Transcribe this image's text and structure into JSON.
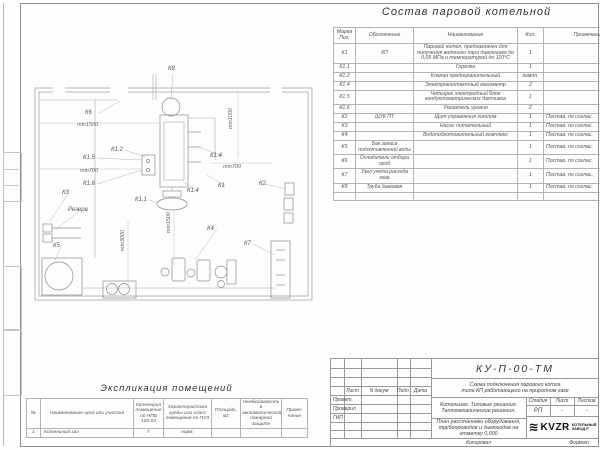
{
  "composition": {
    "title": "Состав паровой котельной",
    "headers": {
      "mark": "Марка Поз.",
      "code": "Обозначение",
      "name": "Наименование",
      "qty": "Кол.",
      "note": "Примечание"
    },
    "rows": [
      {
        "mark": "К1",
        "code": "КП",
        "name": "Паровой котел, предназначен для получения водяного пара давлением до 0,05 МПа и температурой до 110°С",
        "qty": "1",
        "note": ""
      },
      {
        "mark": "К1.1",
        "code": "",
        "name": "Горелка",
        "qty": "1",
        "note": ""
      },
      {
        "mark": "К1.2",
        "code": "",
        "name": "Клапан предохранительный",
        "qty": "компл.",
        "note": ""
      },
      {
        "mark": "К1.4",
        "code": "",
        "name": "Электроконтактный манометр",
        "qty": "2",
        "note": ""
      },
      {
        "mark": "К1.5",
        "code": "",
        "name": "Четырех электродный блок кондуктометрических датчиков",
        "qty": "1",
        "note": ""
      },
      {
        "mark": "К1.6",
        "code": "",
        "name": "Указатель уровня",
        "qty": "2",
        "note": ""
      },
      {
        "mark": "К2",
        "code": "ЩУК ПТ",
        "name": "Щит управления котлом",
        "qty": "1",
        "note": "Постав. по соглас."
      },
      {
        "mark": "К3",
        "code": "",
        "name": "Насос питательный",
        "qty": "1",
        "note": "Постав. по соглас."
      },
      {
        "mark": "К4",
        "code": "",
        "name": "Водоподготовительный комплекс",
        "qty": "1",
        "note": "Постав. по соглас."
      },
      {
        "mark": "К5",
        "code": "Бак запаса подготовленной воды",
        "name": "",
        "qty": "1",
        "note": "Постав. по соглас."
      },
      {
        "mark": "К6",
        "code": "Охладитель отбора проб",
        "name": "",
        "qty": "1",
        "note": "Постав. по соглас."
      },
      {
        "mark": "К7",
        "code": "Узел учета расхода газа",
        "name": "",
        "qty": "1",
        "note": "Постав. по соглас."
      },
      {
        "mark": "К8",
        "code": "Труба дымовая",
        "name": "",
        "qty": "1",
        "note": "Постав. по соглас."
      }
    ]
  },
  "plan": {
    "labels": [
      "К8",
      "К6",
      "min1500",
      "К1.2",
      "К1.5",
      "min700",
      "К1.6",
      "min1000",
      "К1.4",
      "min700",
      "К1",
      "К2",
      "К1.4",
      "К3",
      "Резерв",
      "К1.1",
      "min1500",
      "min3000",
      "К5",
      "К4",
      "К7"
    ]
  },
  "explication": {
    "title": "Экспликация помещений",
    "headers": [
      "№",
      "Наименование цеха или участка",
      "Категория помещения по НПБ 105-03",
      "Характеристика среды или класс помещения по ПУЭ",
      "Площадь, м2",
      "Необходимость в автоматической пожарной защите",
      "Приме- чание"
    ],
    "rows": [
      [
        "1",
        "Котельный зал",
        "Г",
        "норм.",
        "",
        "-",
        ""
      ]
    ]
  },
  "titleblock": {
    "doc_code": "КУ-П-00-ТМ",
    "subtitle1": "Схема подключения парового котла",
    "subtitle2": "типа КП работающего на природном газе",
    "stamp_headers": [
      "Лист",
      "N докум",
      "Подп.",
      "Дата"
    ],
    "roles": [
      "Проект.",
      "Проверил",
      "ГИП"
    ],
    "project_name": "Котельная. Типовые решения. Тепломеханические решения.",
    "sheet_name": "План расстановки оборудования, трубопроводов и дымоходов на отметку 0,000",
    "stage_label": "Стадия",
    "sheet_label": "Лист",
    "sheets_label": "Листов",
    "stage": "РП",
    "sheet_no": "-",
    "sheets_total": "-",
    "logo": "KVZR",
    "company_line1": "КОТЕЛЬНЫЙ",
    "company_line2": "ЗАВОД Р",
    "copied_label": "Копировал",
    "format_label": "Формат"
  }
}
